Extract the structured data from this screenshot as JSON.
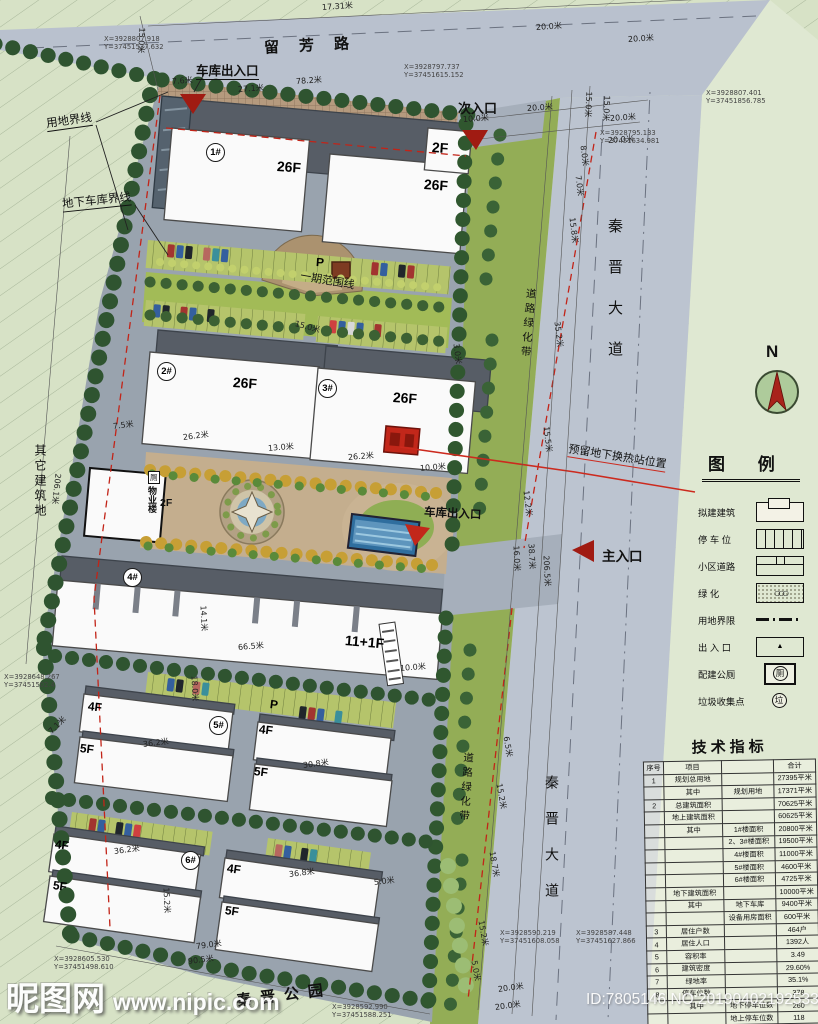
{
  "names": {
    "liufang": "留芳路",
    "qinjin": "秦晋大道",
    "lvhua": "道路绿化带",
    "qita": "其它建筑地",
    "gongyuan": "秦晋公园",
    "north": "N"
  },
  "callouts": {
    "yongdi": "用地界线",
    "dixia": "地下车库界线",
    "garage_top": "车库出入口",
    "ci": "次入口",
    "zhu": "主入口",
    "garage_mid": "车库出入口",
    "yiqi": "一期范围线",
    "yuliu": "预留地下换热站位置",
    "wuye": "物业楼",
    "wuye_f": "2F",
    "wc": "厕"
  },
  "plan": {
    "bnos": [
      {
        "t": "1#",
        "x": 206,
        "y": 143
      },
      {
        "t": "2#",
        "x": 157,
        "y": 362
      },
      {
        "t": "3#",
        "x": 318,
        "y": 379
      },
      {
        "t": "4#",
        "x": 123,
        "y": 568
      },
      {
        "t": "5#",
        "x": 209,
        "y": 716
      },
      {
        "t": "6#",
        "x": 181,
        "y": 851
      }
    ],
    "floors": [
      {
        "t": "26F",
        "x": 277,
        "y": 158,
        "r": 4,
        "cls": "f-lg"
      },
      {
        "t": "26F",
        "x": 424,
        "y": 176,
        "r": 4,
        "cls": "f-lg"
      },
      {
        "t": "2F",
        "x": 432,
        "y": 139,
        "r": 4,
        "cls": "f-lg"
      },
      {
        "t": "26F",
        "x": 233,
        "y": 374,
        "r": 4,
        "cls": "f-lg"
      },
      {
        "t": "26F",
        "x": 393,
        "y": 389,
        "r": 4,
        "cls": "f-lg"
      },
      {
        "t": "11+1F",
        "x": 345,
        "y": 632,
        "r": 5,
        "cls": "f-lg"
      },
      {
        "t": "4F",
        "x": 88,
        "y": 699,
        "r": 7,
        "cls": "f-md"
      },
      {
        "t": "5F",
        "x": 80,
        "y": 741,
        "r": 7,
        "cls": "f-md"
      },
      {
        "t": "4F",
        "x": 259,
        "y": 722,
        "r": 7,
        "cls": "f-md"
      },
      {
        "t": "5F",
        "x": 254,
        "y": 764,
        "r": 7,
        "cls": "f-md"
      },
      {
        "t": "4F",
        "x": 55,
        "y": 837,
        "r": 8,
        "cls": "f-md"
      },
      {
        "t": "5F",
        "x": 53,
        "y": 878,
        "r": 8,
        "cls": "f-md"
      },
      {
        "t": "4F",
        "x": 227,
        "y": 861,
        "r": 8,
        "cls": "f-md"
      },
      {
        "t": "5F",
        "x": 225,
        "y": 903,
        "r": 8,
        "cls": "f-md"
      },
      {
        "t": "P",
        "x": 316,
        "y": 255,
        "r": 4,
        "cls": "f-md"
      },
      {
        "t": "P",
        "x": 270,
        "y": 697,
        "r": 7,
        "cls": "f-md"
      }
    ],
    "dims": [
      {
        "t": "17.31米",
        "x": 322,
        "y": 2,
        "r": -4
      },
      {
        "t": "15.0米",
        "x": 142,
        "y": 22,
        "r": 93
      },
      {
        "t": "20.0米",
        "x": 536,
        "y": 22,
        "r": -4
      },
      {
        "t": "20.0米",
        "x": 628,
        "y": 34,
        "r": -4
      },
      {
        "t": "7.6米",
        "x": 172,
        "y": 76,
        "r": -4
      },
      {
        "t": "27.1米",
        "x": 238,
        "y": 84,
        "r": -4
      },
      {
        "t": "78.2米",
        "x": 296,
        "y": 76,
        "r": -4
      },
      {
        "t": "10.0米",
        "x": 463,
        "y": 114,
        "r": -4
      },
      {
        "t": "20.0米",
        "x": 527,
        "y": 103,
        "r": -4
      },
      {
        "t": "20.0米",
        "x": 610,
        "y": 113,
        "r": -4
      },
      {
        "t": "20.0米",
        "x": 608,
        "y": 135,
        "r": -4
      },
      {
        "t": "15.0米",
        "x": 589,
        "y": 86,
        "r": 93
      },
      {
        "t": "15.0米",
        "x": 607,
        "y": 90,
        "r": 93
      },
      {
        "t": "8.0米",
        "x": 583,
        "y": 140,
        "r": 83
      },
      {
        "t": "7.0米",
        "x": 578,
        "y": 170,
        "r": 83
      },
      {
        "t": "15.8米",
        "x": 572,
        "y": 212,
        "r": 83
      },
      {
        "t": "35.2米",
        "x": 557,
        "y": 316,
        "r": 83
      },
      {
        "t": "15.5米",
        "x": 546,
        "y": 421,
        "r": 83
      },
      {
        "t": "12.2米",
        "x": 526,
        "y": 485,
        "r": 83
      },
      {
        "t": "16.0米",
        "x": 516,
        "y": 540,
        "r": 87
      },
      {
        "t": "38.7米",
        "x": 531,
        "y": 538,
        "r": 87
      },
      {
        "t": "206.5米",
        "x": 546,
        "y": 550,
        "r": 87
      },
      {
        "t": "6.5米",
        "x": 506,
        "y": 731,
        "r": 80
      },
      {
        "t": "15.2米",
        "x": 499,
        "y": 778,
        "r": 80
      },
      {
        "t": "18.7米",
        "x": 492,
        "y": 846,
        "r": 80
      },
      {
        "t": "15.2米",
        "x": 481,
        "y": 915,
        "r": 80
      },
      {
        "t": "5.0米",
        "x": 474,
        "y": 955,
        "r": 80
      },
      {
        "t": "20.0米",
        "x": 498,
        "y": 984,
        "r": -8
      },
      {
        "t": "20.0米",
        "x": 495,
        "y": 1002,
        "r": -8
      },
      {
        "t": "3.0米",
        "x": 456,
        "y": 338,
        "r": 83
      },
      {
        "t": "15.0米",
        "x": 295,
        "y": 318,
        "r": 15
      },
      {
        "t": "7.5米",
        "x": 113,
        "y": 421,
        "r": -7
      },
      {
        "t": "26.2米",
        "x": 183,
        "y": 432,
        "r": -7
      },
      {
        "t": "13.0米",
        "x": 268,
        "y": 443,
        "r": -5
      },
      {
        "t": "26.2米",
        "x": 348,
        "y": 452,
        "r": -5
      },
      {
        "t": "10.0米",
        "x": 420,
        "y": 463,
        "r": -5
      },
      {
        "t": "206.1米",
        "x": 58,
        "y": 468,
        "r": 96
      },
      {
        "t": "14.1米",
        "x": 203,
        "y": 600,
        "r": 87
      },
      {
        "t": "66.5米",
        "x": 238,
        "y": 642,
        "r": -5
      },
      {
        "t": "10.0米",
        "x": 400,
        "y": 663,
        "r": -5
      },
      {
        "t": "18.0米",
        "x": 194,
        "y": 670,
        "r": 87
      },
      {
        "t": "7.1米",
        "x": 50,
        "y": 727,
        "r": -45
      },
      {
        "t": "36.2米",
        "x": 143,
        "y": 739,
        "r": -7
      },
      {
        "t": "30.8米",
        "x": 303,
        "y": 760,
        "r": -7
      },
      {
        "t": "36.2米",
        "x": 114,
        "y": 846,
        "r": -7
      },
      {
        "t": "15.2米",
        "x": 166,
        "y": 882,
        "r": 87
      },
      {
        "t": "36.8米",
        "x": 289,
        "y": 869,
        "r": -7
      },
      {
        "t": "5.0米",
        "x": 374,
        "y": 877,
        "r": -7
      },
      {
        "t": "79.0米",
        "x": 196,
        "y": 941,
        "r": -7
      },
      {
        "t": "90.5米",
        "x": 188,
        "y": 956,
        "r": -7
      }
    ],
    "coords": [
      {
        "a": "X=3928807.918",
        "b": "Y=37451537.632",
        "x": 104,
        "y": 36
      },
      {
        "a": "X=3928797.737",
        "b": "Y=37451615.152",
        "x": 404,
        "y": 64
      },
      {
        "a": "X=3928807.401",
        "b": "Y=37451856.785",
        "x": 706,
        "y": 90
      },
      {
        "a": "X=3928795.133",
        "b": "Y=37451634.981",
        "x": 600,
        "y": 130
      },
      {
        "a": "X=3928648.267",
        "b": "Y=37451502.4",
        "x": 4,
        "y": 674
      },
      {
        "a": "X=3928605.530",
        "b": "Y=37451498.610",
        "x": 54,
        "y": 956
      },
      {
        "a": "X=3928592.990",
        "b": "Y=37451588.251",
        "x": 332,
        "y": 1004
      },
      {
        "a": "X=3928590.219",
        "b": "Y=37451608.058",
        "x": 500,
        "y": 930
      },
      {
        "a": "X=3928587.448",
        "b": "Y=37451627.866",
        "x": 576,
        "y": 930
      }
    ]
  },
  "legend": {
    "title": "图  例",
    "items": [
      {
        "label": "拟建建筑",
        "cls": "sym-building",
        "sym": ""
      },
      {
        "label": "停 车 位",
        "cls": "sym-parking",
        "sym": ""
      },
      {
        "label": "小区道路",
        "cls": "sym-road",
        "sym": ""
      },
      {
        "label": "绿  化",
        "cls": "sym-green",
        "sym": ""
      },
      {
        "label": "用地界限",
        "cls": "sym-boundary",
        "sym": ""
      },
      {
        "label": "出 入 口",
        "cls": "sym-entrance",
        "sym": ""
      },
      {
        "label": "配建公厕",
        "cls": "sym-toilet",
        "sym": "厕"
      },
      {
        "label": "垃圾收集点",
        "cls": "sym-garbage",
        "sym": "垃"
      }
    ]
  },
  "table": {
    "title": "技术指标",
    "rows": [
      [
        "序号",
        "项目",
        "",
        "合计"
      ],
      [
        "1",
        "规划总用地",
        "",
        "27395平米"
      ],
      [
        "",
        "其中",
        "规划用地",
        "17371平米"
      ],
      [
        "2",
        "总建筑面积",
        "",
        "70625平米"
      ],
      [
        "",
        "地上建筑面积",
        "",
        "60625平米"
      ],
      [
        "",
        "其中",
        "1#楼面积",
        "20800平米"
      ],
      [
        "",
        "",
        "2、3#楼面积",
        "19500平米"
      ],
      [
        "",
        "",
        "4#楼面积",
        "11000平米"
      ],
      [
        "",
        "",
        "5#楼面积",
        "4600平米"
      ],
      [
        "",
        "",
        "6#楼面积",
        "4725平米"
      ],
      [
        "",
        "地下建筑面积",
        "",
        "10000平米"
      ],
      [
        "",
        "其中",
        "地下车库",
        "9400平米"
      ],
      [
        "",
        "",
        "设备用房面积",
        "600平米"
      ],
      [
        "3",
        "居住户数",
        "",
        "464户"
      ],
      [
        "4",
        "居住人口",
        "",
        "1392人"
      ],
      [
        "5",
        "容积率",
        "",
        "3.49"
      ],
      [
        "6",
        "建筑密度",
        "",
        "29.60%"
      ],
      [
        "7",
        "绿地率",
        "",
        "35.1%"
      ],
      [
        "8",
        "停车位数",
        "",
        "378"
      ],
      [
        "",
        "其中",
        "地下停车位数",
        "260"
      ],
      [
        "",
        "",
        "地上停车位数",
        "118"
      ]
    ]
  },
  "watermark": {
    "site": "昵图网",
    "url": "www.nipic.com",
    "id_text": "ID:7805146 NO:20190402192533152000"
  }
}
